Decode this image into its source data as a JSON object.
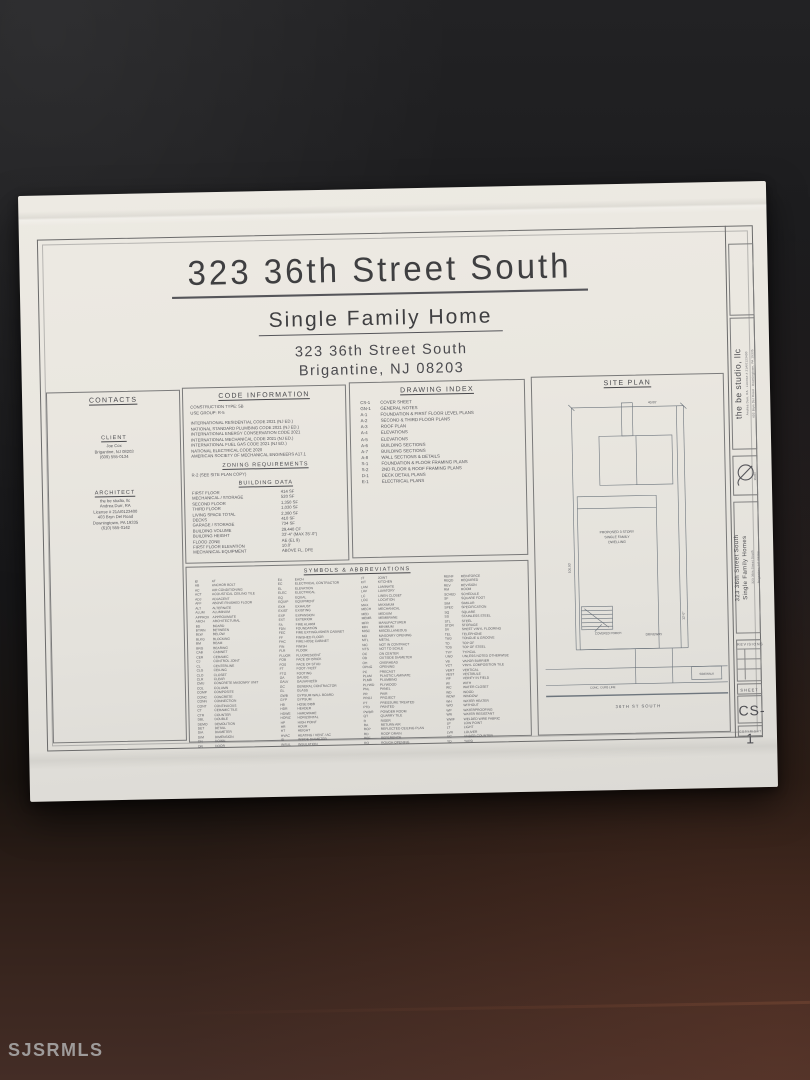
{
  "photo": {
    "watermark": "SJSRMLS"
  },
  "colors": {
    "paper": "#eae7e0",
    "background_dark": "#1b1b1d",
    "desk_brown": "#3b2720",
    "ink": "#55555a"
  },
  "sheet": {
    "title": "323 36th Street South",
    "subtitle": "Single Family Home",
    "address_line1": "323 36th Street South",
    "address_line2": "Brigantine, NJ  08203"
  },
  "contacts": {
    "header": "CONTACTS",
    "client": {
      "header": "CLIENT",
      "lines": [
        "Joe Cox",
        "Brigantine, NJ 08203",
        "(609) 555-0134"
      ]
    },
    "architect": {
      "header": "ARCHITECT",
      "lines": [
        "the be studio, llc",
        "Andrea Durr, RA",
        "License # 21AI0123400",
        "403 Bryn Del Road",
        "Downingtown, PA 19335",
        "(610) 555-0142"
      ]
    }
  },
  "code_info": {
    "header": "CODE INFORMATION",
    "top_lines": [
      "CONSTRUCTION TYPE: 5B",
      "USE GROUP: R-5"
    ],
    "code_lines": [
      "INTERNATIONAL RESIDENTIAL CODE 2021 (NJ ED.)",
      "NATIONAL STANDARD PLUMBING CODE 2021 (NJ ED.)",
      "INTERNATIONAL ENERGY CONSERVATION CODE 2021",
      "INTERNATIONAL MECHANICAL CODE 2021 (NJ ED.)",
      "INTERNATIONAL FUEL GAS CODE 2021 (NJ ED.)",
      "NATIONAL ELECTRICAL CODE 2020",
      "AMERICAN SOCIETY OF MECHANICAL ENGINEERS A17.1"
    ]
  },
  "zoning": {
    "header": "ZONING REQUIREMENTS",
    "lines": [
      "R-2 (SEE SITE PLAN COPY)"
    ]
  },
  "building_data": {
    "header": "BUILDING DATA",
    "rows": [
      [
        "FIRST FLOOR",
        "414 SF"
      ],
      [
        "MECHANICAL / STORAGE",
        "520 SF"
      ],
      [
        "SECOND FLOOR",
        "1,350 SF"
      ],
      [
        "THIRD FLOOR",
        "1,030 SF"
      ],
      [
        "LIVING SPACE TOTAL",
        "2,380 SF"
      ],
      [
        "DECKS",
        "410 SF"
      ],
      [
        "GARAGE / STORAGE",
        "734 SF"
      ],
      [
        "BUILDING VOLUME",
        "29,440 CF"
      ],
      [
        "BUILDING HEIGHT",
        "33'-4\" (MAX 35'-0\")"
      ],
      [
        "FLOOD ZONE",
        "AE (EL 9)"
      ],
      [
        "FIRST FLOOR ELEVATION",
        "10.0'"
      ],
      [
        "MECHANICAL EQUIPMENT",
        "ABOVE FL. DFE"
      ]
    ]
  },
  "drawing_index": {
    "header": "DRAWING INDEX",
    "rows": [
      [
        "CS-1",
        "COVER SHEET"
      ],
      [
        "GN-1",
        "GENERAL NOTES"
      ],
      [
        "A-1",
        "FOUNDATION & FIRST FLOOR LEVEL PLANS"
      ],
      [
        "A-2",
        "SECOND & THIRD FLOOR PLANS"
      ],
      [
        "A-3",
        "ROOF PLAN"
      ],
      [
        "A-4",
        "ELEVATIONS"
      ],
      [
        "A-5",
        "ELEVATIONS"
      ],
      [
        "A-6",
        "BUILDING SECTIONS"
      ],
      [
        "A-7",
        "BUILDING SECTIONS"
      ],
      [
        "A-8",
        "WALL SECTIONS & DETAILS"
      ],
      [
        "S-1",
        "FOUNDATION & FLOOR FRAMING PLANS"
      ],
      [
        "S-2",
        "2ND FLOOR & ROOF FRAMING PLANS"
      ],
      [
        "D-1",
        "DECK DETAIL PLANS"
      ],
      [
        "E-1",
        "ELECTRICAL PLANS"
      ]
    ]
  },
  "symbols": {
    "header": "SYMBOLS & ABBREVIATIONS",
    "groups": [
      [
        [
          "@",
          "AT"
        ],
        [
          "AB",
          "ANCHOR BOLT"
        ],
        [
          "AC",
          "AIR CONDITIONING"
        ],
        [
          "ACT",
          "ACOUSTICAL CEILING TILE"
        ],
        [
          "ADJ",
          "ADJACENT"
        ],
        [
          "AFF",
          "ABOVE FINISHED FLOOR"
        ],
        [
          "ALT",
          "ALTERNATE"
        ],
        [
          "ALUM",
          "ALUMINUM"
        ],
        [
          "APPROX",
          "APPROXIMATE"
        ],
        [
          "ARCH",
          "ARCHITECTURAL"
        ],
        [
          "BD",
          "BOARD"
        ],
        [
          "BTWN",
          "BETWEEN"
        ],
        [
          "BLW",
          "BELOW"
        ],
        [
          "BLKG",
          "BLOCKING"
        ],
        [
          "BM",
          "BEAM"
        ],
        [
          "BRG",
          "BEARING"
        ],
        [
          "CAB",
          "CABINET"
        ],
        [
          "CER",
          "CERAMIC"
        ],
        [
          "CJ",
          "CONTROL JOINT"
        ],
        [
          "CL",
          "CENTERLINE"
        ],
        [
          "CLG",
          "CEILING"
        ],
        [
          "CLO",
          "CLOSET"
        ],
        [
          "CLR",
          "CLEAR"
        ],
        [
          "CMU",
          "CONCRETE MASONRY UNIT"
        ],
        [
          "COL",
          "COLUMN"
        ],
        [
          "COMP",
          "COMPOSITE"
        ],
        [
          "CONC",
          "CONCRETE"
        ],
        [
          "CONN",
          "CONNECTION"
        ],
        [
          "CONT",
          "CONTINUOUS"
        ],
        [
          "CT",
          "CERAMIC TILE"
        ],
        [
          "CTR",
          "COUNTER"
        ],
        [
          "DBL",
          "DOUBLE"
        ],
        [
          "DEMO",
          "DEMOLITION"
        ],
        [
          "DET",
          "DETAIL"
        ],
        [
          "DIA",
          "DIAMETER"
        ],
        [
          "DIM",
          "DIMENSION"
        ],
        [
          "DN",
          "DOWN"
        ],
        [
          "DR",
          "DOOR"
        ]
      ],
      [
        [
          "EA",
          "EACH"
        ],
        [
          "EC",
          "ELECTRICAL CONTRACTOR"
        ],
        [
          "EL",
          "ELEVATION"
        ],
        [
          "ELEC",
          "ELECTRICAL"
        ],
        [
          "EQ",
          "EQUAL"
        ],
        [
          "EQUIP",
          "EQUIPMENT"
        ],
        [
          "EXH",
          "EXHAUST"
        ],
        [
          "EXIST",
          "EXISTING"
        ],
        [
          "EXP",
          "EXPANSION"
        ],
        [
          "EXT",
          "EXTERIOR"
        ],
        [
          "FA",
          "FIRE ALARM"
        ],
        [
          "FDN",
          "FOUNDATION"
        ],
        [
          "FEC",
          "FIRE EXTINGUISHER CABINET"
        ],
        [
          "FF",
          "FINISHED FLOOR"
        ],
        [
          "FHC",
          "FIRE HOSE CABINET"
        ],
        [
          "FIN",
          "FINISH"
        ],
        [
          "FLR",
          "FLOOR"
        ],
        [
          "FLUOR",
          "FLUORESCENT"
        ],
        [
          "FOB",
          "FACE OF BRICK"
        ],
        [
          "FOS",
          "FACE OF STUD"
        ],
        [
          "FT",
          "FOOT / FEET"
        ],
        [
          "FTG",
          "FOOTING"
        ],
        [
          "GA",
          "GAUGE"
        ],
        [
          "GALV",
          "GALVANIZED"
        ],
        [
          "GC",
          "GENERAL CONTRACTOR"
        ],
        [
          "GL",
          "GLASS"
        ],
        [
          "GWB",
          "GYPSUM WALL BOARD"
        ],
        [
          "GYP",
          "GYPSUM"
        ],
        [
          "HB",
          "HOSE BIBB"
        ],
        [
          "HDR",
          "HEADER"
        ],
        [
          "HDWE",
          "HARDWARE"
        ],
        [
          "HORIZ",
          "HORIZONTAL"
        ],
        [
          "HP",
          "HIGH POINT"
        ],
        [
          "HR",
          "HOUR"
        ],
        [
          "HT",
          "HEIGHT"
        ],
        [
          "HVAC",
          "HEATING / VENT / AC"
        ],
        [
          "ID",
          "INSIDE DIAMETER"
        ],
        [
          "INSUL",
          "INSULATION"
        ]
      ],
      [
        [
          "JT",
          "JOINT"
        ],
        [
          "KIT",
          "KITCHEN"
        ],
        [
          "LAM",
          "LAMINATE"
        ],
        [
          "LAV",
          "LAVATORY"
        ],
        [
          "LC",
          "LINEN CLOSET"
        ],
        [
          "LOC",
          "LOCATION"
        ],
        [
          "MAX",
          "MAXIMUM"
        ],
        [
          "MECH",
          "MECHANICAL"
        ],
        [
          "MED",
          "MEDIUM"
        ],
        [
          "MEMB",
          "MEMBRANE"
        ],
        [
          "MFR",
          "MANUFACTURER"
        ],
        [
          "MIN",
          "MINIMUM"
        ],
        [
          "MISC",
          "MISCELLANEOUS"
        ],
        [
          "MO",
          "MASONRY OPENING"
        ],
        [
          "MTL",
          "METAL"
        ],
        [
          "NIC",
          "NOT IN CONTRACT"
        ],
        [
          "NTS",
          "NOT TO SCALE"
        ],
        [
          "OC",
          "ON CENTER"
        ],
        [
          "OD",
          "OUTSIDE DIAMETER"
        ],
        [
          "OH",
          "OVERHEAD"
        ],
        [
          "OPNG",
          "OPENING"
        ],
        [
          "PC",
          "PRECAST"
        ],
        [
          "PLAM",
          "PLASTIC LAMINATE"
        ],
        [
          "PLMB",
          "PLUMBING"
        ],
        [
          "PLYWD",
          "PLYWOOD"
        ],
        [
          "PNL",
          "PANEL"
        ],
        [
          "PR",
          "PAIR"
        ],
        [
          "PROJ",
          "PROJECT"
        ],
        [
          "PT",
          "PRESSURE TREATED"
        ],
        [
          "PTD",
          "PAINTED"
        ],
        [
          "PWDR",
          "POWDER ROOM"
        ],
        [
          "QT",
          "QUARRY TILE"
        ],
        [
          "R",
          "RISER"
        ],
        [
          "RA",
          "RETURN AIR"
        ],
        [
          "RCP",
          "REFLECTED CEILING PLAN"
        ],
        [
          "RD",
          "ROOF DRAIN"
        ],
        [
          "REF",
          "REFERENCE"
        ],
        [
          "RO",
          "ROUGH OPENING"
        ]
      ],
      [
        [
          "REINF",
          "REINFORCE"
        ],
        [
          "REQD",
          "REQUIRED"
        ],
        [
          "REV",
          "REVISION"
        ],
        [
          "RM",
          "ROOM"
        ],
        [
          "SCHED",
          "SCHEDULE"
        ],
        [
          "SF",
          "SQUARE FOOT"
        ],
        [
          "SIM",
          "SIMILAR"
        ],
        [
          "SPEC",
          "SPECIFICATION"
        ],
        [
          "SQ",
          "SQUARE"
        ],
        [
          "SS",
          "STAINLESS STEEL"
        ],
        [
          "STL",
          "STEEL"
        ],
        [
          "STOR",
          "STORAGE"
        ],
        [
          "SV",
          "SHEET VINYL FLOORING"
        ],
        [
          "TEL",
          "TELEPHONE"
        ],
        [
          "T&G",
          "TONGUE & GROOVE"
        ],
        [
          "TO",
          "TOP OF"
        ],
        [
          "TOS",
          "TOP OF STEEL"
        ],
        [
          "TYP",
          "TYPICAL"
        ],
        [
          "UNO",
          "UNLESS NOTED OTHERWISE"
        ],
        [
          "VB",
          "VAPOR BARRIER"
        ],
        [
          "VCT",
          "VINYL COMPOSITION TILE"
        ],
        [
          "VERT",
          "VERTICAL"
        ],
        [
          "VEST",
          "VESTIBULE"
        ],
        [
          "VIF",
          "VERIFY IN FIELD"
        ],
        [
          "W/",
          "WITH"
        ],
        [
          "WC",
          "WATER CLOSET"
        ],
        [
          "WD",
          "WOOD"
        ],
        [
          "WDW",
          "WINDOW"
        ],
        [
          "WH",
          "WATER HEATER"
        ],
        [
          "W/O",
          "WITHOUT"
        ],
        [
          "WP",
          "WATERPROOFING"
        ],
        [
          "WR",
          "WATER RESISTANT"
        ],
        [
          "WWF",
          "WELDED WIRE FABRIC"
        ],
        [
          "LP",
          "LOW POINT"
        ],
        [
          "LT",
          "LIGHT"
        ],
        [
          "LVR",
          "LOUVER"
        ],
        [
          "UC",
          "UNDER COUNTER"
        ],
        [
          "YD",
          "YARD"
        ]
      ]
    ]
  },
  "site_plan": {
    "header": "SITE PLAN",
    "building_lines": [
      "PROPOSED 3 STORY",
      "SINGLE FAMILY",
      "DWELLING"
    ],
    "porch_label": "COVERED PORCH",
    "driveway_label": "DRIVEWAY",
    "sidewalk_label": "SIDEWALK",
    "curb_label": "CONC. CURB LINE",
    "street_label": "36TH ST SOUTH",
    "dim_top": "40.00'",
    "dim_left": "100.00'",
    "dim_right": "12'-0\""
  },
  "titleblock": {
    "firm_name": "the be studio, llc",
    "firm_line1": "Andrea Durr, RA · License # 21AI0123400",
    "firm_line2": "403 Bryn Del Road · Downingtown, PA 19335",
    "project_line1": "323 36th Street South",
    "project_line2": "Single Family Homes",
    "project_addr1": "323 36th Street South",
    "project_addr2": "Brigantine, NJ 08203",
    "rev_label": "REVISIONS",
    "sheet_label": "SHEET",
    "sheet_number": "CS-1",
    "footer_note": "COPYRIGHT"
  }
}
